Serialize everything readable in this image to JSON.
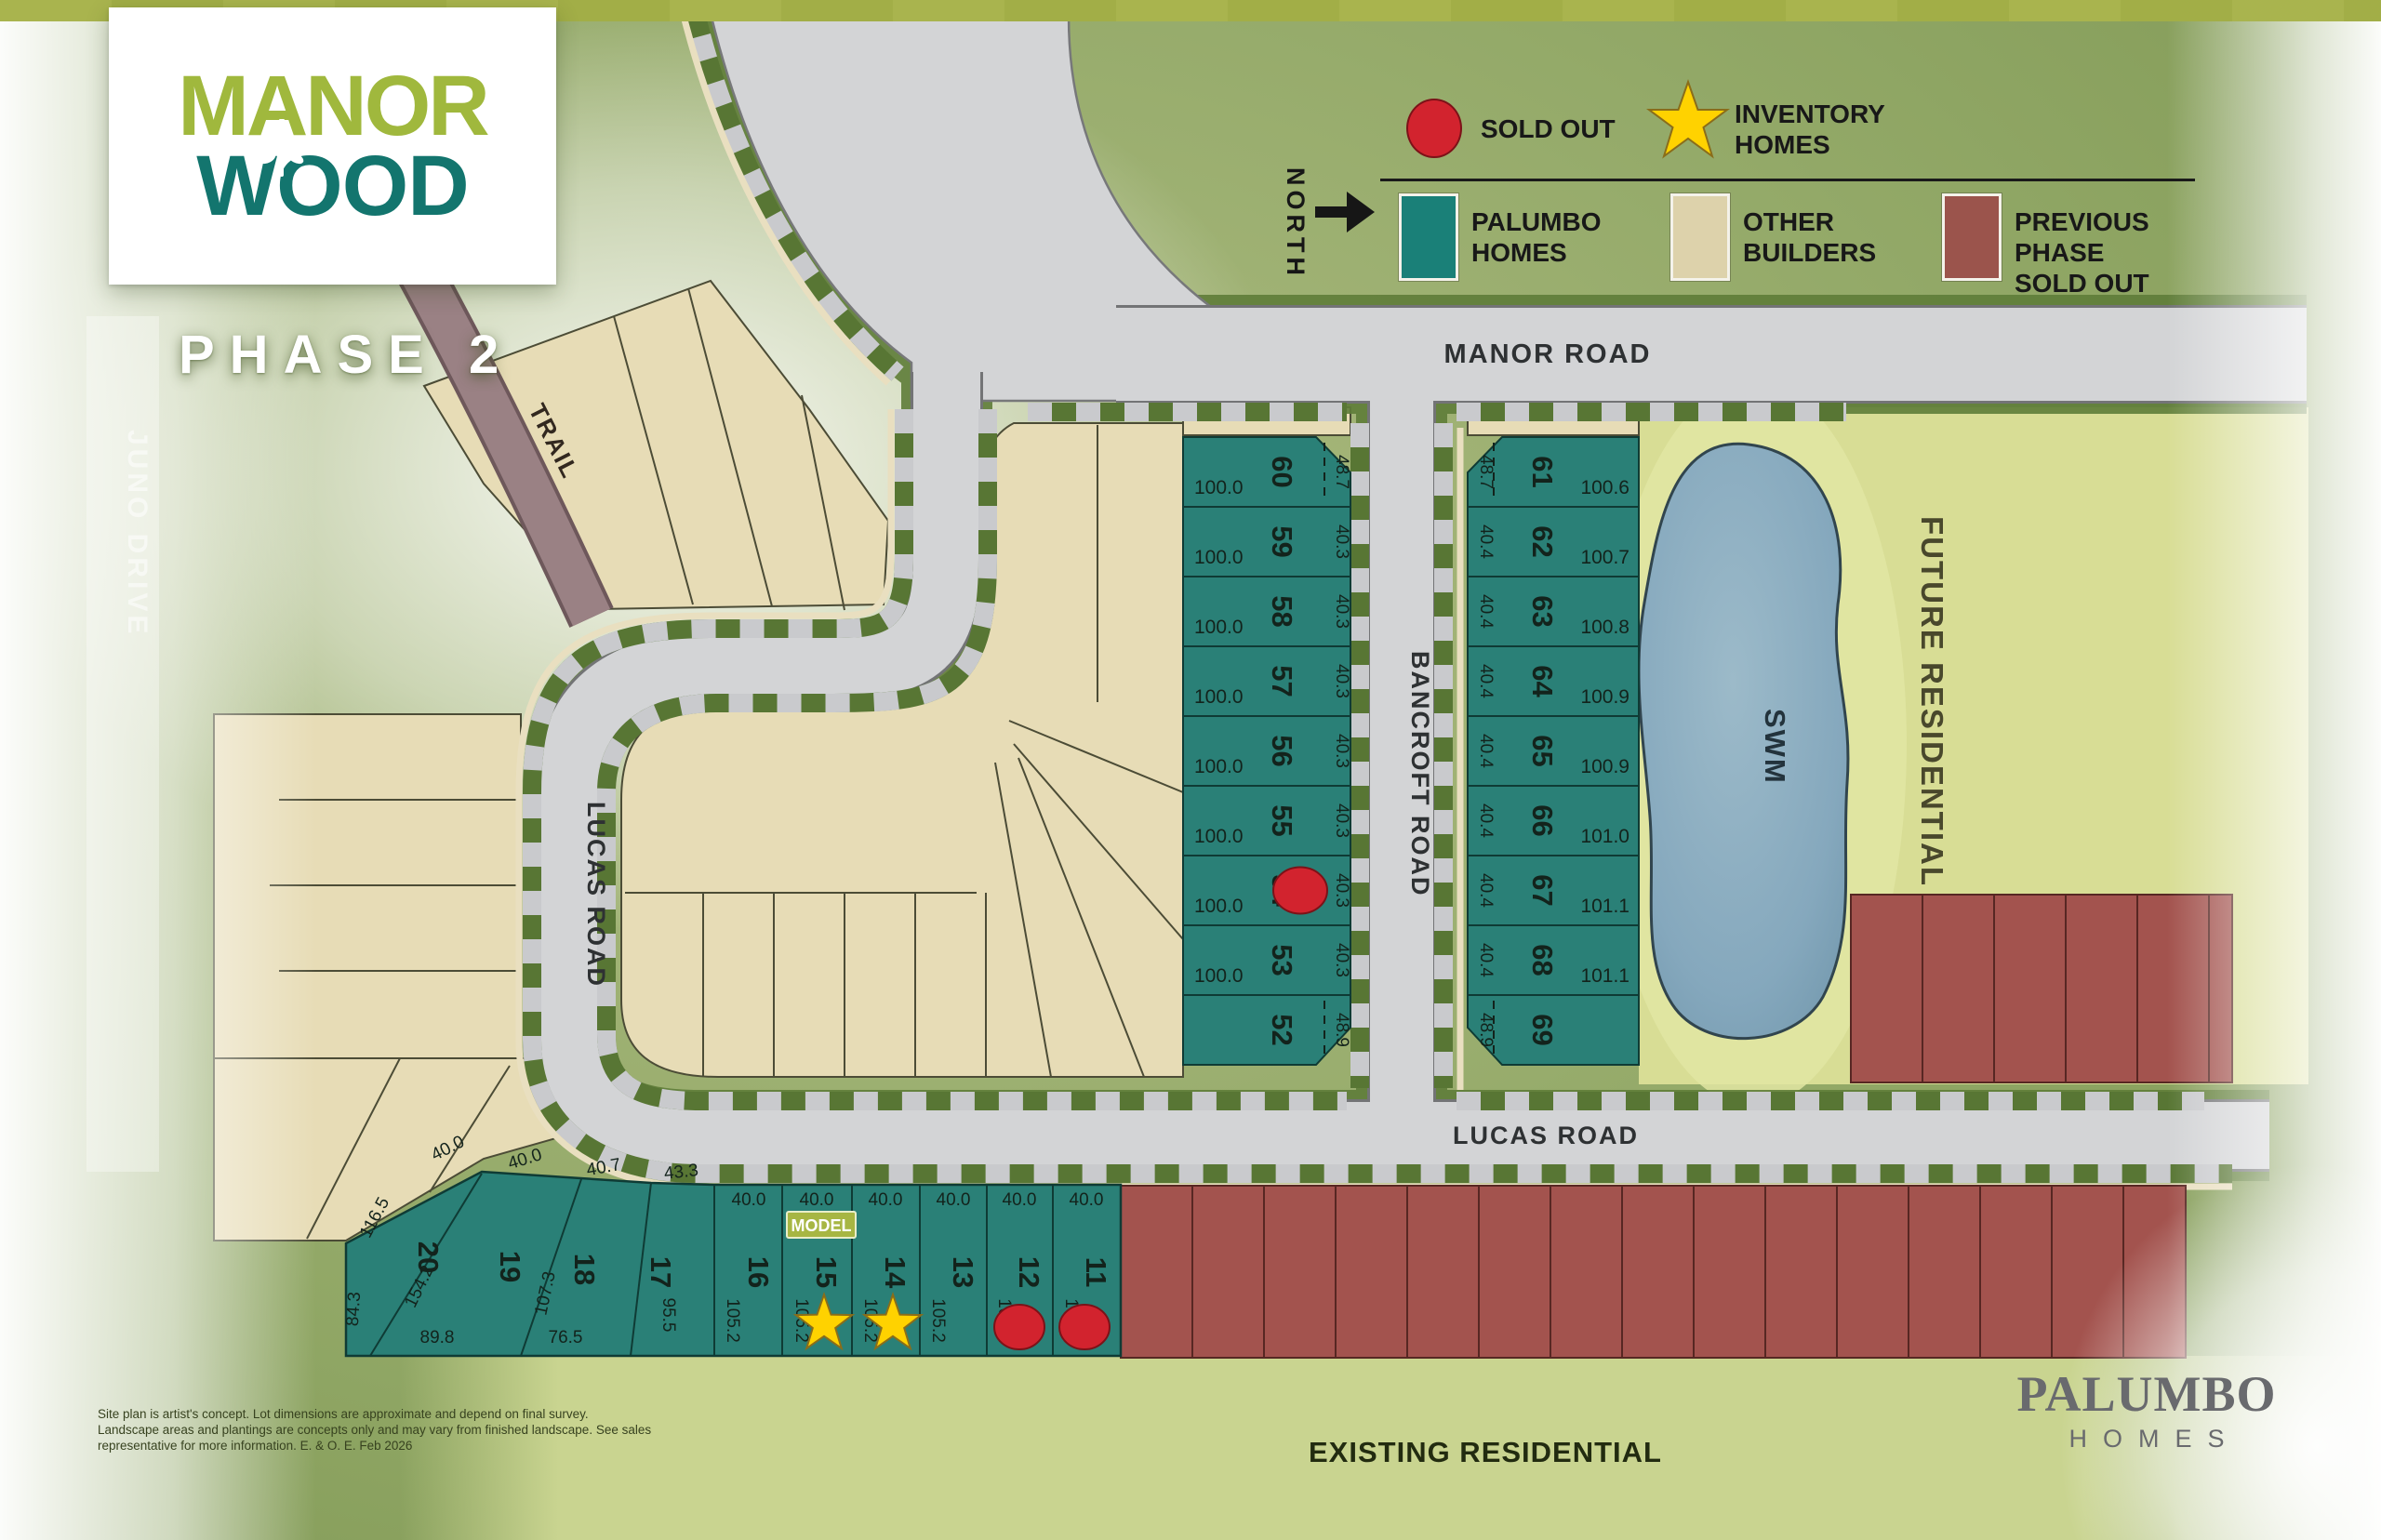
{
  "header": {
    "logo_top": "MANOR",
    "logo_bottom": "WOOD",
    "phase": "PHASE 2"
  },
  "legend": {
    "sold_out": "SOLD OUT",
    "inventory_homes": "INVENTORY\nHOMES",
    "palumbo_homes": "PALUMBO\nHOMES",
    "other_builders": "OTHER\nBUILDERS",
    "previous_phase": "PREVIOUS PHASE\nSOLD OUT"
  },
  "compass": {
    "north": "NORTH"
  },
  "roads": {
    "manor": "MANOR ROAD",
    "bancroft": "BANCROFT ROAD",
    "lucas_vertical": "LUCAS ROAD",
    "lucas_horizontal": "LUCAS ROAD",
    "trail": "TRAIL",
    "juno": "JUNO DRIVE"
  },
  "areas": {
    "swm": "SWM",
    "future": "FUTURE RESIDENTIAL",
    "existing": "EXISTING RESIDENTIAL",
    "model": "MODEL"
  },
  "builder_logo": {
    "name": "PALUMBO",
    "suffix": "HOMES"
  },
  "disclaimer": [
    "Site plan is artist's concept.  Lot dimensions are approximate and depend on final survey.",
    "Landscape areas and plantings are concepts only and may vary from finished landscape. See sales",
    "representative for more information. E. & O. E. Feb 2026"
  ],
  "colors": {
    "palumbo_teal": "#1A8078",
    "other_builders_beige": "#DDD2AB",
    "previous_phase_red": "#9B544C",
    "sold_out_red": "#D2232E",
    "inventory_yellow": "#FFD200"
  },
  "lots": {
    "west_column": [
      {
        "num": "60",
        "frontage": "48.7",
        "depth": "100.0"
      },
      {
        "num": "59",
        "frontage": "40.3",
        "depth": "100.0"
      },
      {
        "num": "58",
        "frontage": "40.3",
        "depth": "100.0"
      },
      {
        "num": "57",
        "frontage": "40.3",
        "depth": "100.0"
      },
      {
        "num": "56",
        "frontage": "40.3",
        "depth": "100.0"
      },
      {
        "num": "55",
        "frontage": "40.3",
        "depth": "100.0"
      },
      {
        "num": "54",
        "frontage": "40.3",
        "depth": "100.0",
        "sold": true
      },
      {
        "num": "53",
        "frontage": "40.3",
        "depth": "100.0"
      },
      {
        "num": "52",
        "frontage": "48.9",
        "depth": ""
      }
    ],
    "east_column": [
      {
        "num": "61",
        "frontage": "48.7",
        "depth": "100.6"
      },
      {
        "num": "62",
        "frontage": "40.4",
        "depth": "100.7"
      },
      {
        "num": "63",
        "frontage": "40.4",
        "depth": "100.8"
      },
      {
        "num": "64",
        "frontage": "40.4",
        "depth": "100.9"
      },
      {
        "num": "65",
        "frontage": "40.4",
        "depth": "100.9"
      },
      {
        "num": "66",
        "frontage": "40.4",
        "depth": "101.0"
      },
      {
        "num": "67",
        "frontage": "40.4",
        "depth": "101.1"
      },
      {
        "num": "68",
        "frontage": "40.4",
        "depth": "101.1"
      },
      {
        "num": "69",
        "frontage": "48.9",
        "depth": ""
      }
    ],
    "south_row": [
      {
        "num": "20",
        "frontage": "40.0",
        "dims": [
          "116.5",
          "84.3"
        ]
      },
      {
        "num": "19",
        "frontage": "40.0",
        "dims": [
          "154.2",
          "89.8"
        ]
      },
      {
        "num": "18",
        "frontage": "40.7",
        "dims": [
          "107.3",
          "76.5"
        ]
      },
      {
        "num": "17",
        "frontage": "43.3",
        "dims": [
          "95.5"
        ]
      },
      {
        "num": "16",
        "frontage": "40.0",
        "dims": [
          "105.2"
        ]
      },
      {
        "num": "15",
        "frontage": "40.0",
        "dims": [
          "105.2"
        ],
        "model": true,
        "inventory": true
      },
      {
        "num": "14",
        "frontage": "40.0",
        "dims": [
          "105.2"
        ],
        "inventory": true
      },
      {
        "num": "13",
        "frontage": "40.0",
        "dims": [
          "105.2"
        ]
      },
      {
        "num": "12",
        "frontage": "40.0",
        "dims": [
          "105.2"
        ],
        "sold": true
      },
      {
        "num": "11",
        "frontage": "40.0",
        "dims": [
          "105.2"
        ],
        "sold": true
      }
    ]
  }
}
